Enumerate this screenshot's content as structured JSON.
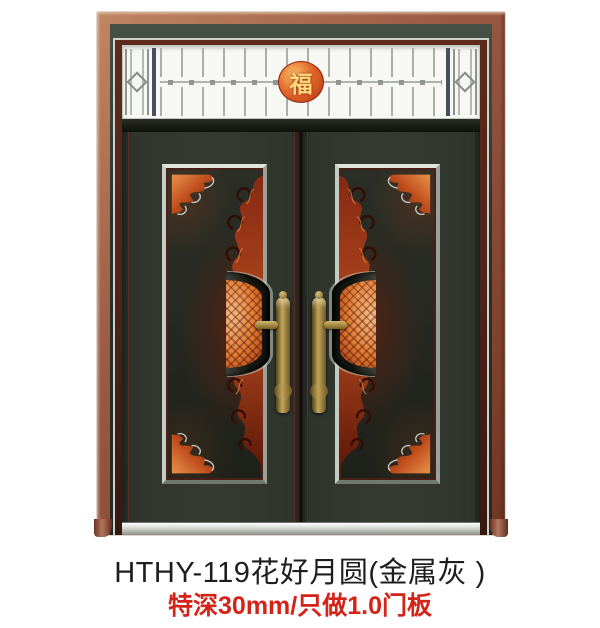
{
  "caption": {
    "title": "HTHY-119花好月圆(金属灰 )",
    "subtitle": "特深30mm/只做1.0门板"
  },
  "door": {
    "fu_character": "福",
    "decorations": [
      "transom-grille",
      "fu-medallion",
      "corner-ornament",
      "scroll-ornament",
      "half-moon-medallion",
      "brass-handle"
    ],
    "colors": {
      "frame_copper": "#9a5b43",
      "jamb_maroon": "#4d241b",
      "leaf_dark": "#2e332c",
      "bevel_silver": "#c9cfc8",
      "ornament_orange": "#e07a31",
      "ornament_dark_red": "#6d2013",
      "handle_brass": "#6e5724",
      "sill_silver": "#c6c9c5",
      "title_color": "#1e1e1e",
      "subtitle_color": "#d42318"
    }
  }
}
